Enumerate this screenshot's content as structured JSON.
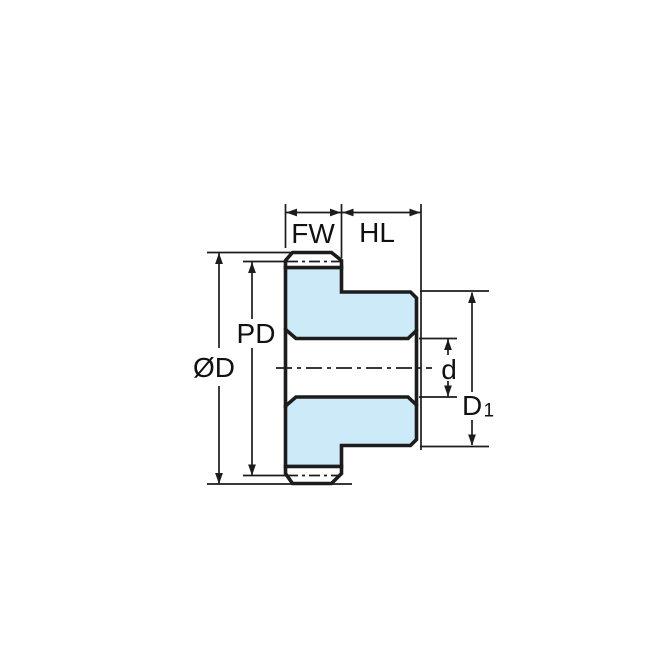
{
  "diagram": {
    "labels": {
      "face_width": "FW",
      "hub_length": "HL",
      "pitch_diameter": "PD",
      "outer_diameter": "ØD",
      "bore_diameter": "d",
      "hub_diameter_main": "D",
      "hub_diameter_sub": "1"
    },
    "colors": {
      "body_fill": "#cdeaf9",
      "tooth_fill": "#ffffff",
      "line": "#1c1c1c",
      "background": "#ffffff"
    }
  }
}
